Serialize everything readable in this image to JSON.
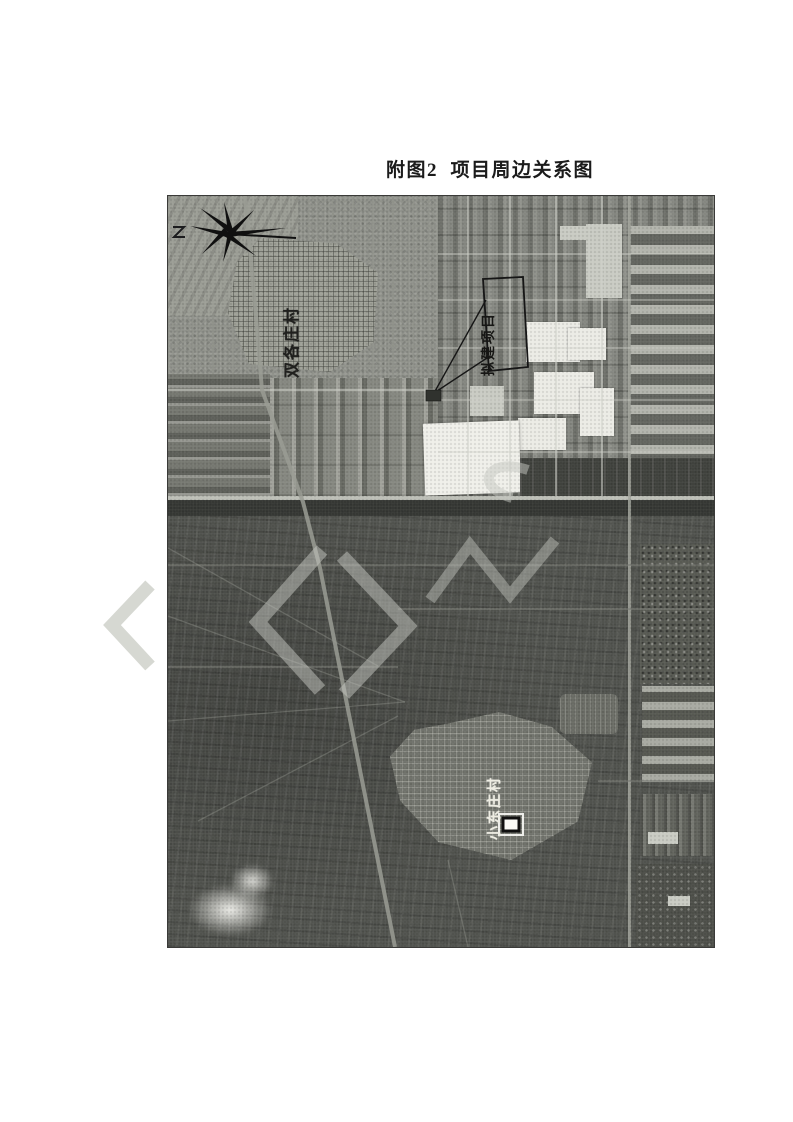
{
  "figure": {
    "title": "附图2  项目周边关系图"
  },
  "map": {
    "type": "grayscale-aerial-photograph",
    "labels": {
      "village_north": "双各庄村",
      "project_box": "拟建项目",
      "village_south": "小东庄村"
    },
    "compass": {
      "icon": "compass-rose-icon",
      "side_mark": "Z"
    },
    "marker": {
      "icon": "location-marker-icon"
    },
    "watermark": {
      "name": "WPS",
      "color": "#d6d8d2"
    },
    "colors": {
      "north_zone": "#8e9089",
      "south_zone": "#4f514c",
      "road": "#bcbeb6",
      "road_shadow": "#333531",
      "white_building": "#ece??",
      "white_building_fixed": "#eceae4",
      "annotation_ink": "#1a1a1a"
    }
  }
}
